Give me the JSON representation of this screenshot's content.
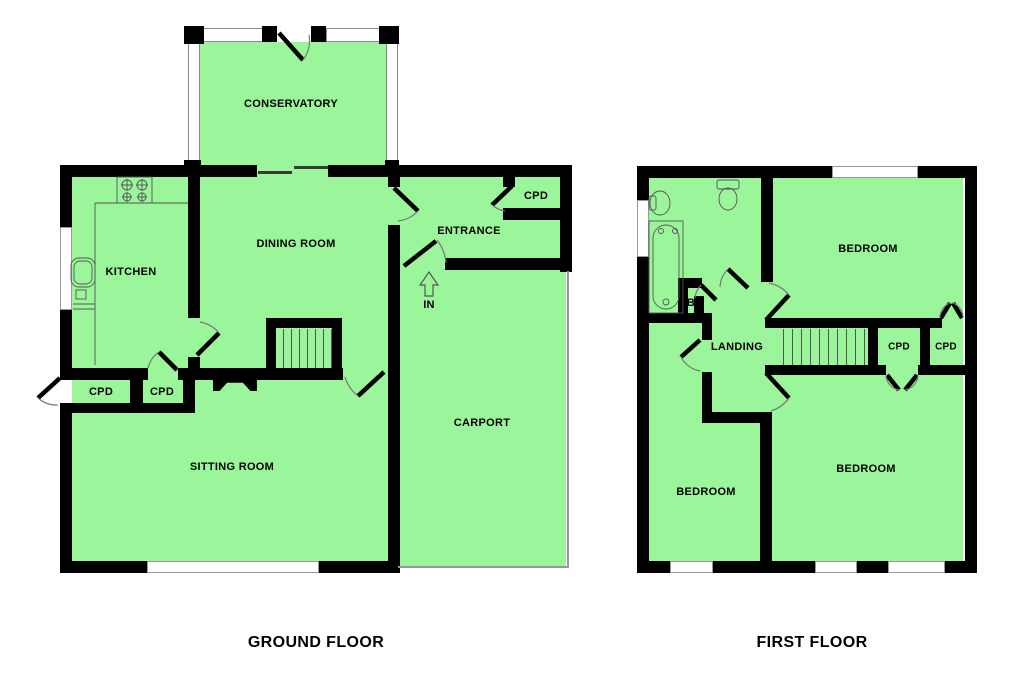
{
  "ground": {
    "title": "GROUND FLOOR",
    "labels": {
      "conservatory": "CONSERVATORY",
      "dining_room": "DINING ROOM",
      "kitchen": "KITCHEN",
      "entrance": "ENTRANCE",
      "entrance_cpd": "CPD",
      "in": "IN",
      "carport": "CARPORT",
      "sitting_room": "SITTING ROOM",
      "cpd_left": "CPD",
      "cpd_right": "CPD"
    }
  },
  "first": {
    "title": "FIRST FLOOR",
    "labels": {
      "bedroom_top": "BEDROOM",
      "landing": "LANDING",
      "bath_cupboard": "B",
      "cpd_left": "CPD",
      "cpd_right": "CPD",
      "bedroom_bottom_left": "BEDROOM",
      "bedroom_bottom_right": "BEDROOM"
    }
  },
  "colors": {
    "room_fill": "#9bf59b",
    "wall": "#000000",
    "detail_line": "#555555",
    "carport_line": "#999999"
  }
}
